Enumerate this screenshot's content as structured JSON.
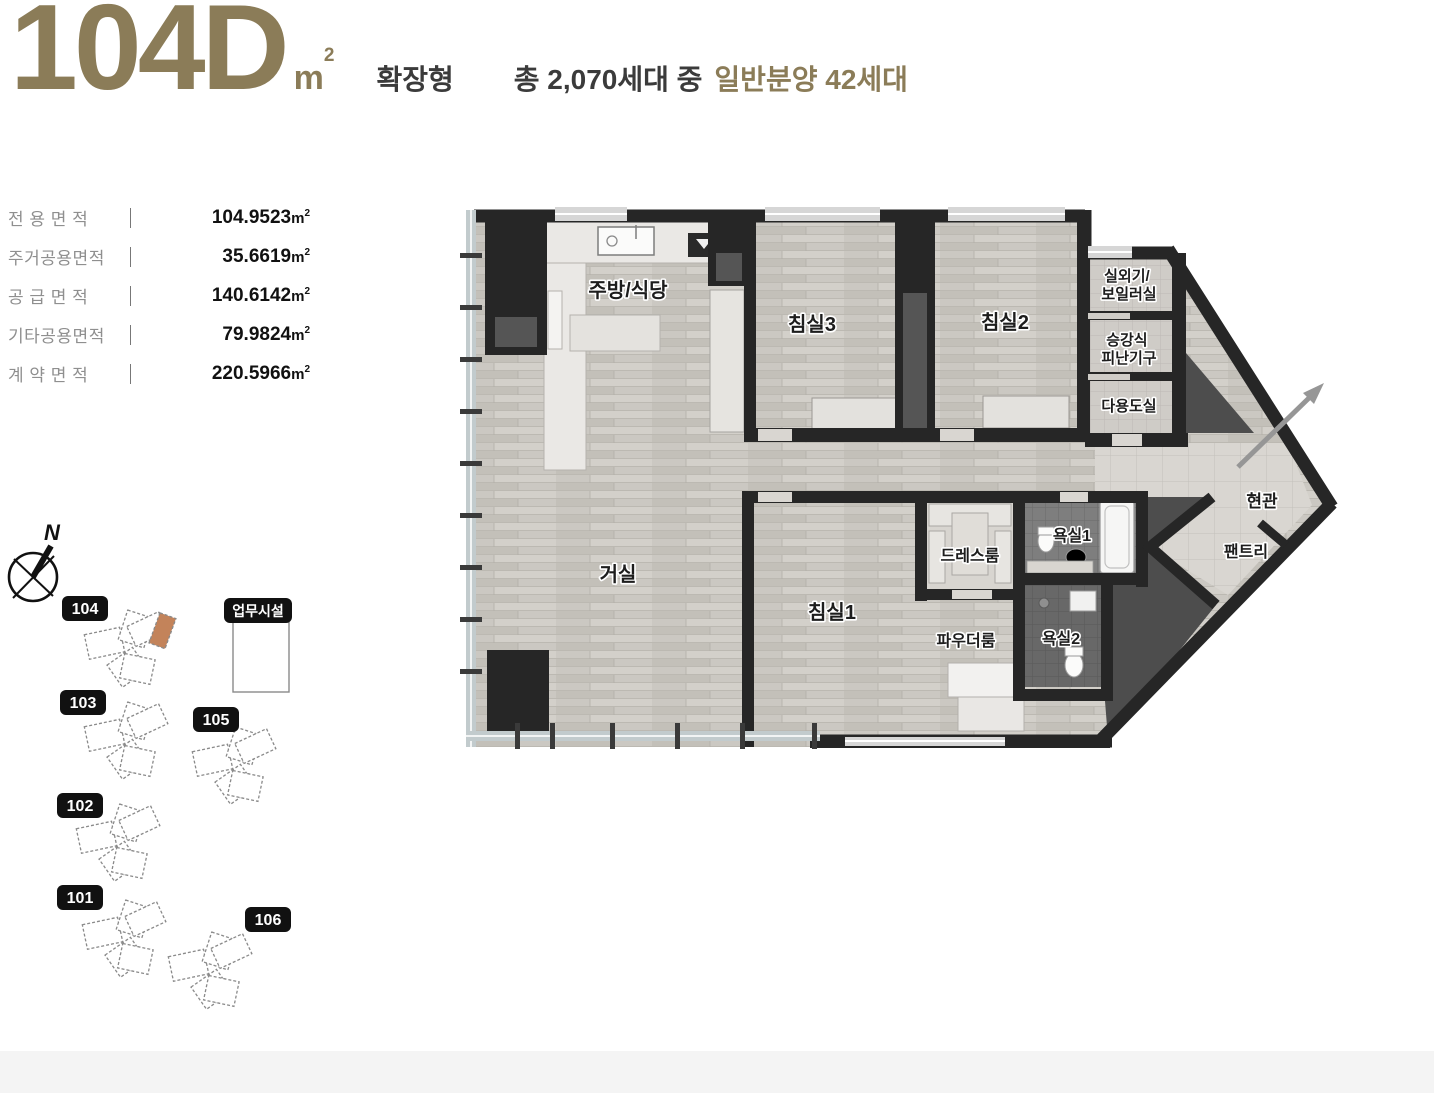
{
  "header": {
    "unit_code": "104D",
    "unit_symbol_m": "m",
    "unit_symbol_sup": "2",
    "type_label": "확장형",
    "total_households": "총 2,070세대 중",
    "general_sale": "일반분양 42세대",
    "accent_color": "#8b7c58"
  },
  "area_table": {
    "rows": [
      {
        "label": "전 용 면 적",
        "value": "104.9523",
        "unit_m": "m",
        "unit_sup": "2"
      },
      {
        "label": "주거공용면적",
        "value": "35.6619",
        "unit_m": "m",
        "unit_sup": "2"
      },
      {
        "label": "공 급 면 적",
        "value": "140.6142",
        "unit_m": "m",
        "unit_sup": "2"
      },
      {
        "label": "기타공용면적",
        "value": "79.9824",
        "unit_m": "m",
        "unit_sup": "2"
      },
      {
        "label": "계 약 면 적",
        "value": "220.5966",
        "unit_m": "m",
        "unit_sup": "2"
      }
    ]
  },
  "site_plan": {
    "compass_label": "N",
    "facility_label": "업무시설",
    "highlight_color": "#c3835a",
    "buildings": [
      {
        "id": "104",
        "highlighted": true
      },
      {
        "id": "103",
        "highlighted": false
      },
      {
        "id": "105",
        "highlighted": false
      },
      {
        "id": "102",
        "highlighted": false
      },
      {
        "id": "101",
        "highlighted": false
      },
      {
        "id": "106",
        "highlighted": false
      }
    ]
  },
  "floor_plan": {
    "rooms": {
      "kitchen": "주방/식당",
      "bedroom3": "침실3",
      "bedroom2": "침실2",
      "outdoor_unit_line1": "실외기/",
      "outdoor_unit_line2": "보일러실",
      "escape_line1": "승강식",
      "escape_line2": "피난기구",
      "utility": "다용도실",
      "living": "거실",
      "bedroom1": "침실1",
      "dressroom": "드레스룸",
      "bath1": "욕실1",
      "powder": "파우더룸",
      "bath2": "욕실2",
      "entrance": "현관",
      "pantry": "팬트리"
    },
    "colors": {
      "wall": "#262626",
      "wood_floor": "#cbc8c2",
      "entry_tile": "#dcd9d4",
      "bath_tile": "#7e7e7e",
      "core": "#4d4d4d"
    }
  }
}
